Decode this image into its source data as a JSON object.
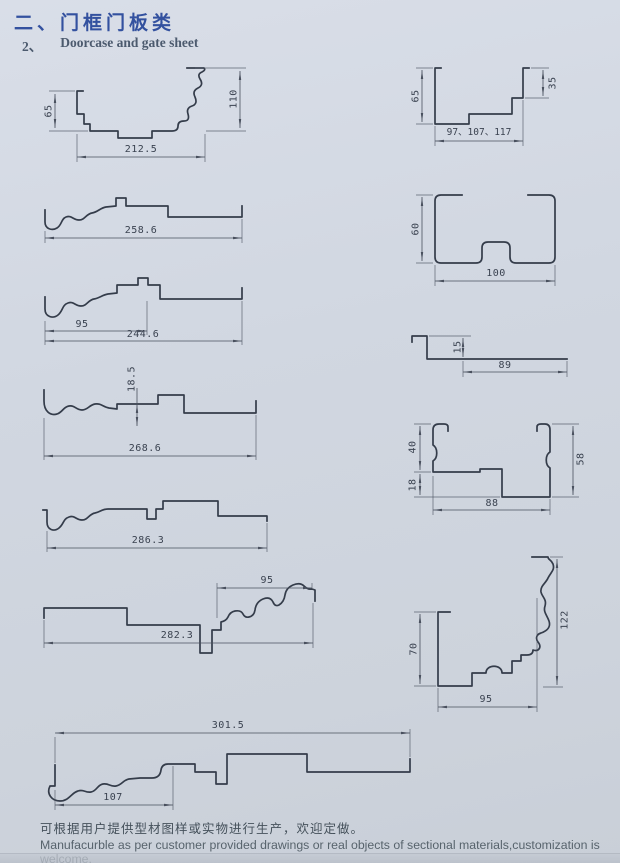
{
  "page": {
    "title_cn": "二、门框门板类",
    "subtitle_num": "2、",
    "subtitle_en": "Doorcase and gate sheet",
    "footer_cn": "可根据用户提供型材图样或实物进行生产，欢迎定做。",
    "footer_en": "Manufacurble as per customer provided drawings or real objects of sectional materials,customization is welcome."
  },
  "colors": {
    "title_blue": "#33519f",
    "profile_line": "#343c4a",
    "dimension_line": "#49505e",
    "paper": "#d1d7e1"
  },
  "figures": {
    "l1": {
      "d_left": "65",
      "d_right": "110",
      "d_width": "212.5"
    },
    "l2": {
      "d_width": "258.6"
    },
    "l3": {
      "d_seg": "95",
      "d_width": "244.6"
    },
    "l4": {
      "d_step": "18.5",
      "d_width": "268.6"
    },
    "l5": {
      "d_width": "286.3"
    },
    "l6": {
      "d_seg": "95",
      "d_width": "282.3"
    },
    "l7": {
      "d_width": "301.5",
      "d_seg": "107"
    },
    "r1": {
      "d_left": "65",
      "d_right": "35",
      "d_width": "97、107、117"
    },
    "r2": {
      "d_left": "60",
      "d_width": "100"
    },
    "r3": {
      "d_height": "15",
      "d_width": "89"
    },
    "r4": {
      "d_upper": "40",
      "d_lower": "18",
      "d_width": "88",
      "d_right": "58"
    },
    "r5": {
      "d_left": "70",
      "d_right": "122",
      "d_width": "95"
    }
  }
}
